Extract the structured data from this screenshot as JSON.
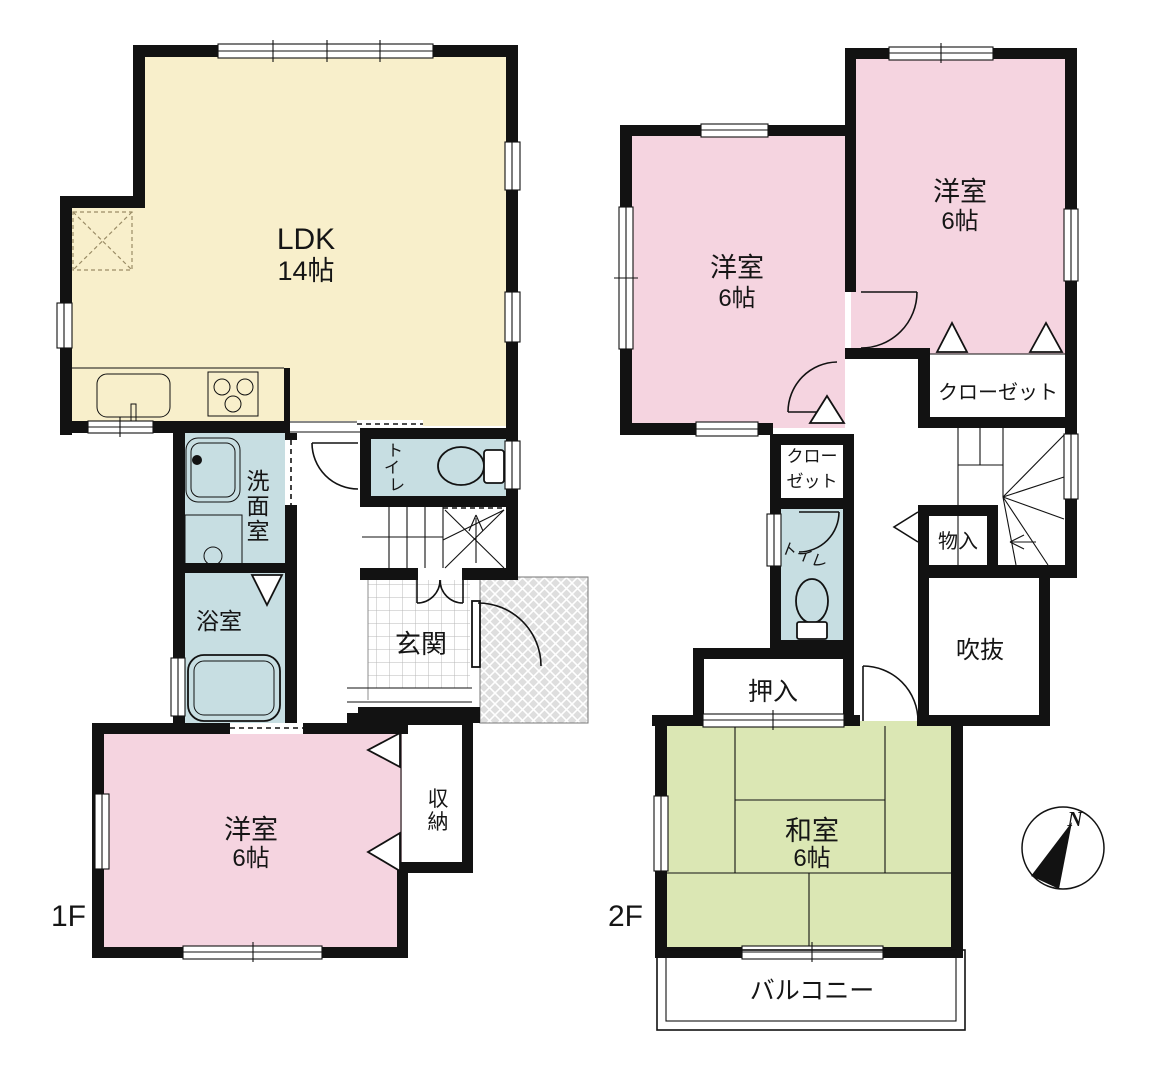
{
  "floor1": {
    "label": "1F",
    "ldk": {
      "name": "LDK",
      "size": "14帖"
    },
    "washroom": "洗面室",
    "toilet": "トイレ",
    "bath": "浴室",
    "entrance": "玄関",
    "bedroom": {
      "name": "洋室",
      "size": "6帖"
    },
    "storage": "収納"
  },
  "floor2": {
    "label": "2F",
    "bedroom_left": {
      "name": "洋室",
      "size": "6帖"
    },
    "bedroom_right": {
      "name": "洋室",
      "size": "6帖"
    },
    "closet_main": "クローゼット",
    "closet_small": {
      "line1": "クロー",
      "line2": "ゼット"
    },
    "toilet": "トイレ",
    "storage": "物入",
    "void": "吹抜",
    "futon_closet": "押入",
    "japanese_room": {
      "name": "和室",
      "size": "6帖"
    },
    "balcony": "バルコニー"
  },
  "compass": {
    "north": "N"
  },
  "colors": {
    "wall": "#121212",
    "ldk_fill": "#f8efcb",
    "western_room_fill": "#f5d4e0",
    "sanitary_fill": "#c7dee2",
    "japanese_room_fill": "#dbe7b4",
    "porch_fill": "#dedede"
  }
}
